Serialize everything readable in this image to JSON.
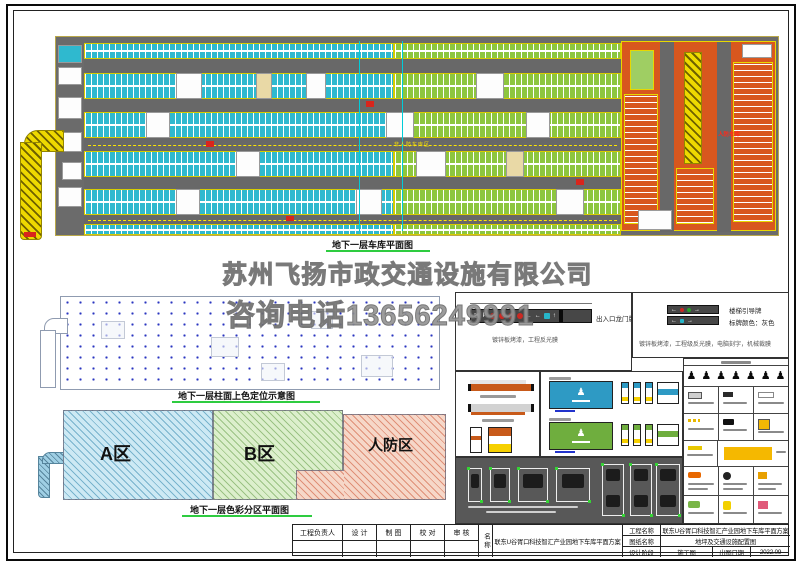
{
  "watermark": {
    "company": "苏州飞扬市政交通设施有限公司",
    "phone": "咨询电话13656249991"
  },
  "plan": {
    "title": "地下一层车库平面图",
    "label_civil_defense": "人防车库",
    "label_non_civil_defense": "非人防车库区"
  },
  "column_diagram": {
    "title": "地下一层柱面上色定位示意图"
  },
  "zone_diagram": {
    "title": "地下一层色彩分区平面图",
    "zone_a": "A区",
    "zone_b": "B区",
    "zone_defense": "人防区"
  },
  "details": {
    "gantry_label": "出入口龙门牌",
    "gantry_note": "镀锌板烤漆，工程反光膜",
    "stair_label": "楼梯引导牌",
    "stair_color_note": "标牌颜色：灰色",
    "stair_spec": "镀锌板烤漆，工程级反光膜，电脑刻字，机械裁膜"
  },
  "title_block": {
    "col_manager": "工程负责人",
    "col_design": "设 计",
    "col_draft": "制 图",
    "col_check": "校 对",
    "col_review": "审 核",
    "name_label": "名称",
    "project_name": "联东U谷胥口科技智汇产业园地下车库平面方案",
    "row_project_label": "工程名称",
    "row_project_value": "联东U谷胥口科技智汇产业园地下车库平面方案",
    "row_drawing_label": "图纸名称",
    "row_drawing_value": "地坪及交通设施配置图",
    "row_stage_label": "设计阶段",
    "row_stage_value": "施工图",
    "row_date_label": "出图日期",
    "row_date_value": "2022.09"
  },
  "colors": {
    "accent_green": "#2ecc40",
    "stall_cyan": "#2fb9cf",
    "stall_green": "#8dc63f",
    "defense_orange": "#d8571e",
    "ramp_yellow": "#eed900",
    "lane_gray": "#686868"
  }
}
